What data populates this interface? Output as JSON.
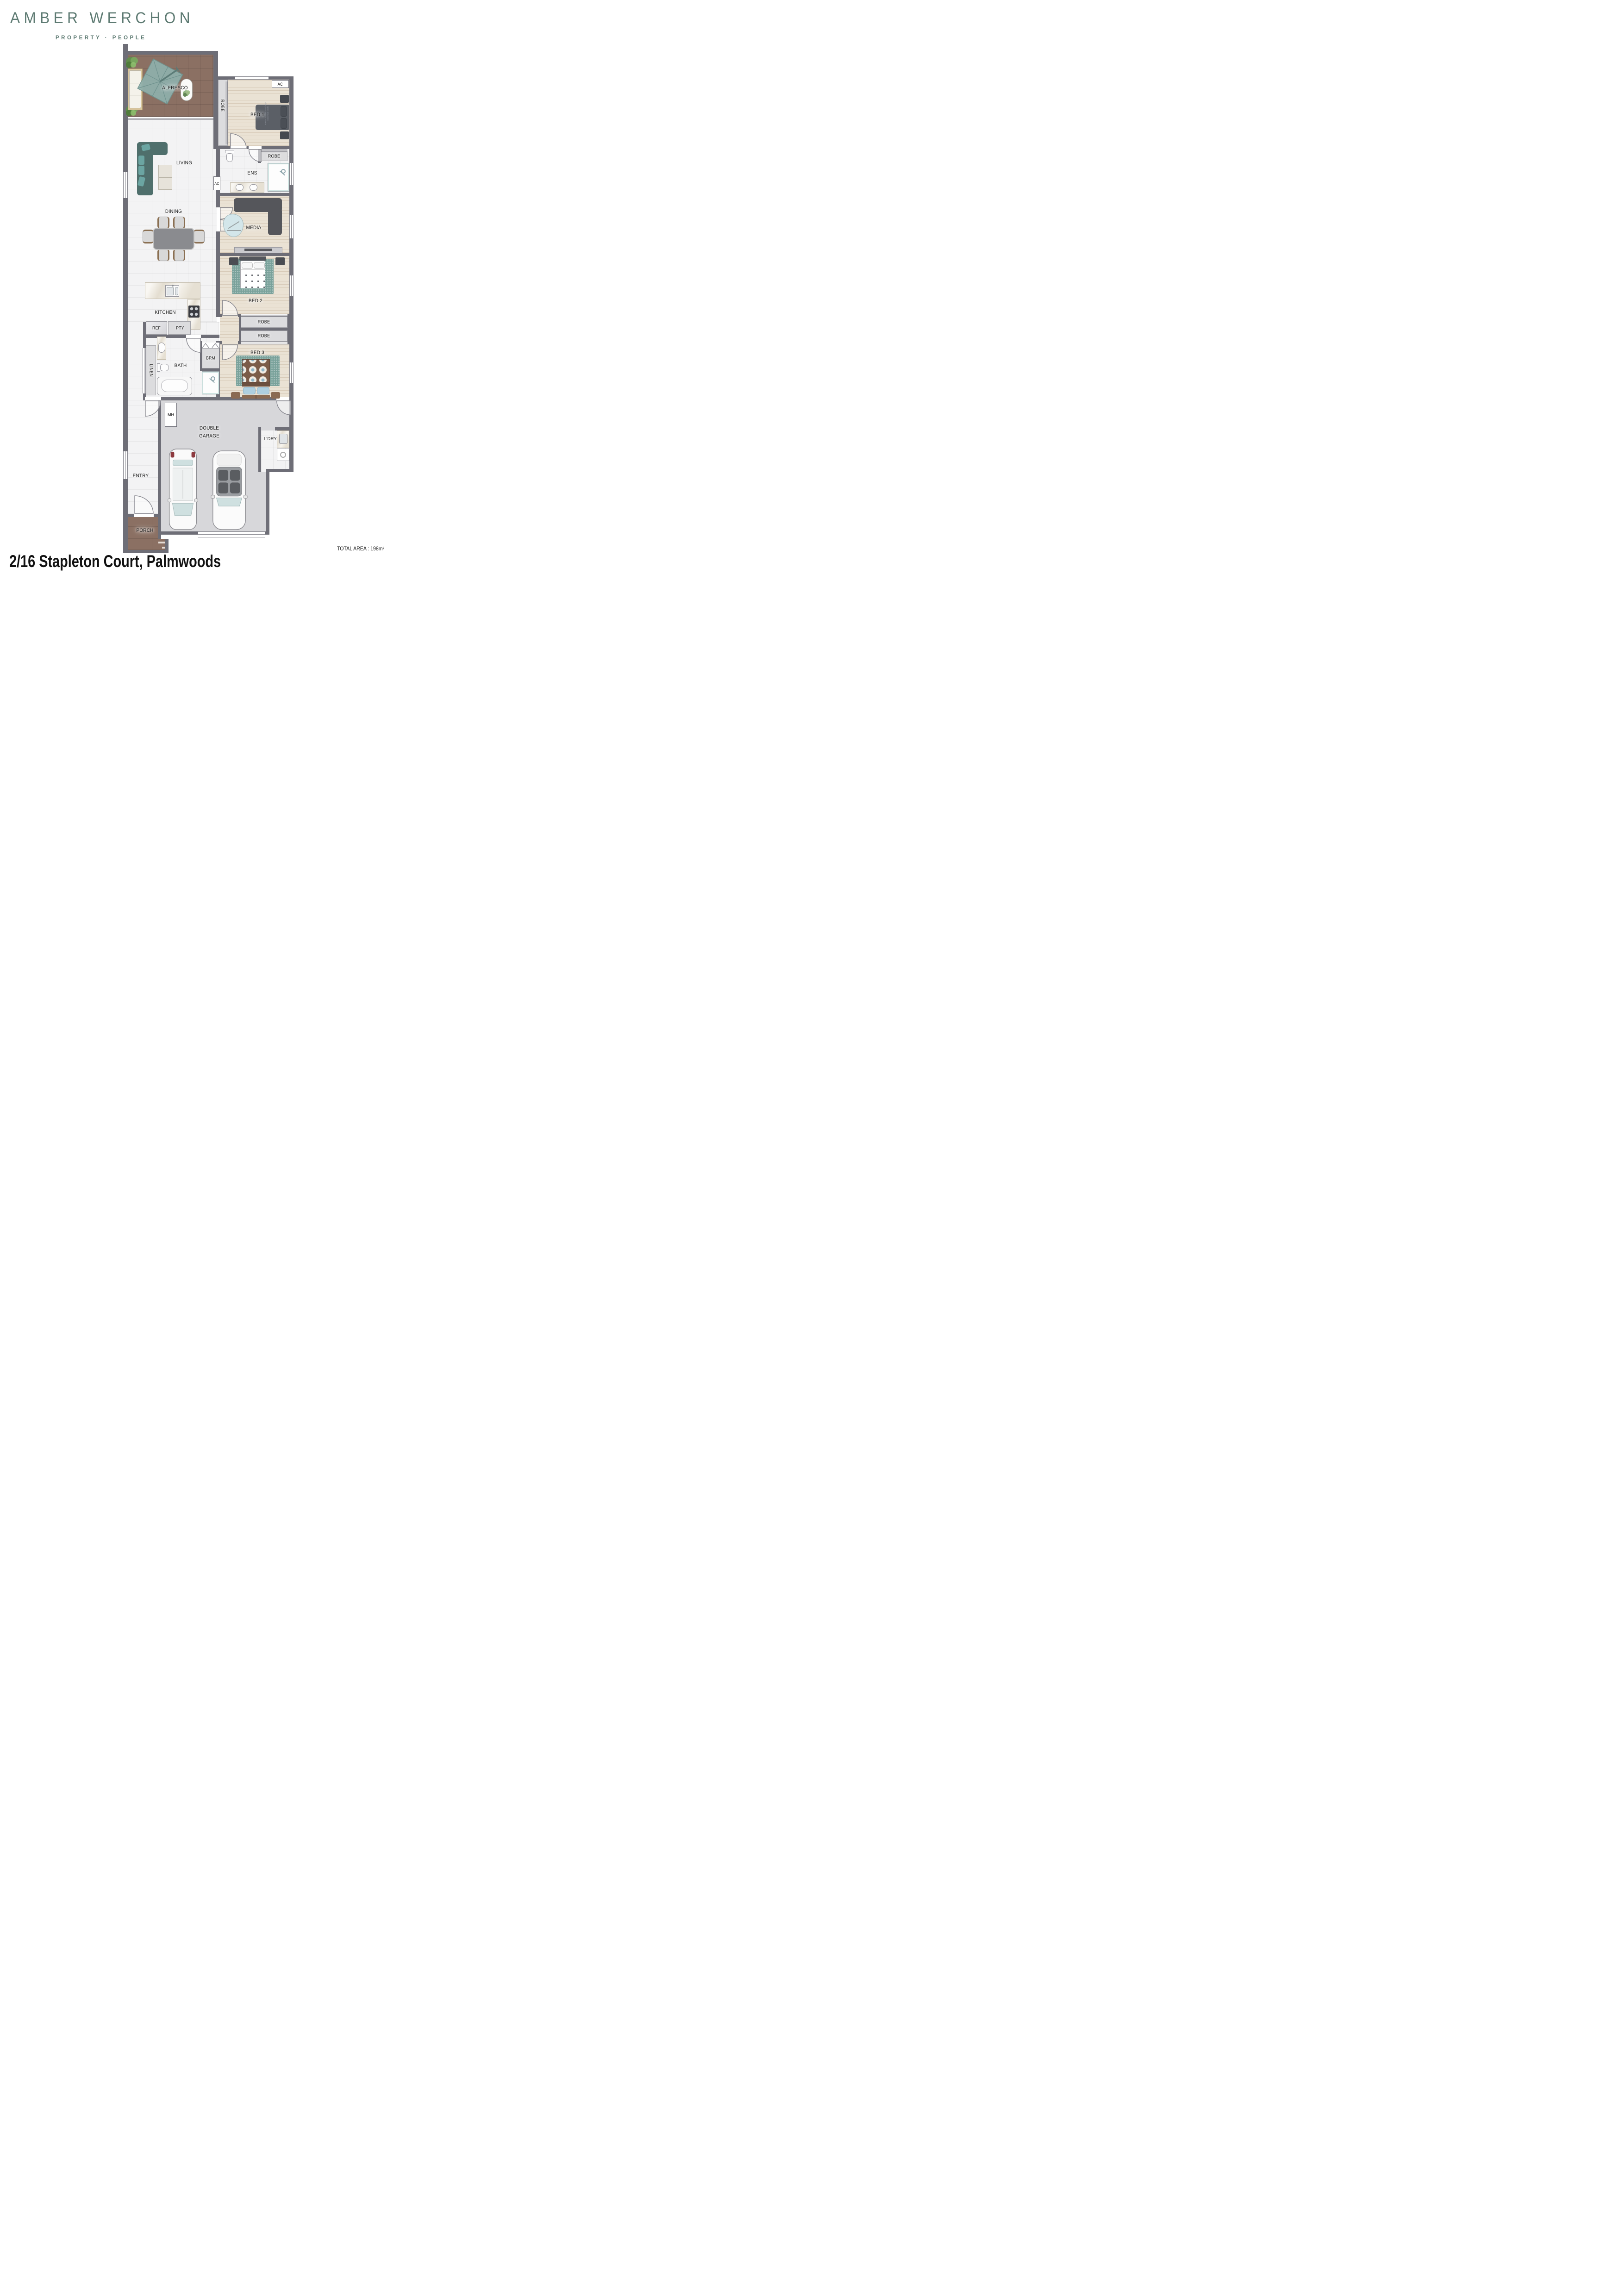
{
  "brand": {
    "name": "AMBER WERCHON",
    "tagline": "PROPERTY · PEOPLE"
  },
  "rooms": {
    "alfresco": "ALFRESCO",
    "living": "LIVING",
    "dining": "DINING",
    "kitchen": "KITCHEN",
    "media": "MEDIA",
    "bed1": "BED 1",
    "bed2": "BED 2",
    "bed3": "BED 3",
    "ens": "ENS",
    "bath": "BATH",
    "entry": "ENTRY",
    "porch": "PORCH",
    "garage": "DOUBLE GARAGE",
    "ldry": "L'DRY",
    "linen": "LINEN",
    "brm": "BRM",
    "ref": "REF",
    "pty": "PTY",
    "mh": "MH",
    "robe": "ROBE",
    "ac": "AC"
  },
  "bed1_duvet_text": "Buenas Noches Good Night bonne nuit Nacht",
  "footer": {
    "address": "2/16 Stapleton Court, Palmwoods",
    "total_area": "TOTAL AREA : 198m²"
  },
  "colors": {
    "brand_green": "#5d7a72",
    "wall_gray": "#6e6e77",
    "alfresco_brown": "#8b7063",
    "wood_floor": "#eae2d4",
    "tile_floor": "#f3f3f4",
    "garage_gray": "#d7d7da",
    "rug_teal": "#7aa29b"
  }
}
